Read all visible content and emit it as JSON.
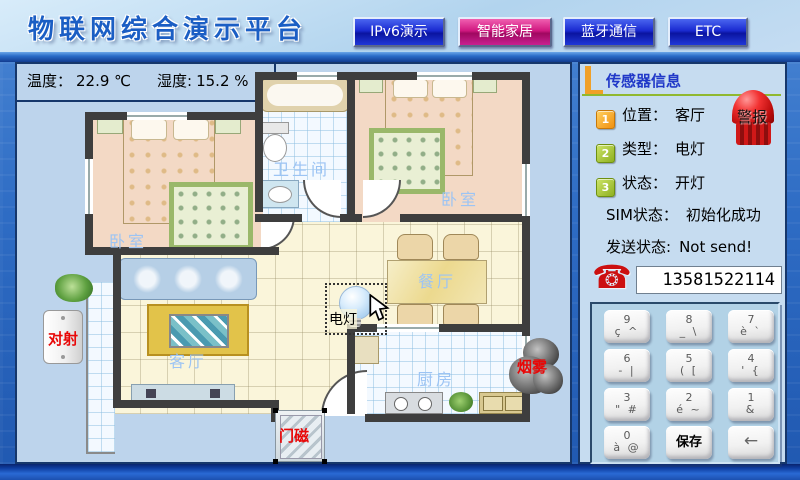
{
  "header": {
    "title": "物联网综合演示平台",
    "tabs": [
      {
        "label": "IPv6演示"
      },
      {
        "label": "智能家居"
      },
      {
        "label": "蓝牙通信"
      },
      {
        "label": "ETC"
      }
    ]
  },
  "env": {
    "temp_label": "温度：",
    "temp_value": "22.9 ℃",
    "hum_label": "湿度:",
    "hum_value": "15.2 %"
  },
  "floorplan": {
    "rooms": {
      "bedroom_left": "卧室",
      "bathroom": "卫生间",
      "bedroom_right": "卧室",
      "dining": "餐厅",
      "living": "客厅",
      "kitchen": "厨房"
    },
    "sensors": {
      "beam": "对射",
      "door_magnet": "门磁",
      "lamp": "电灯",
      "smoke": "烟雾"
    }
  },
  "sensor_panel": {
    "title": "传感器信息",
    "alarm_label": "警报",
    "items": [
      {
        "num": "1",
        "label": "位置：",
        "value": "客厅"
      },
      {
        "num": "2",
        "label": "类型：",
        "value": "电灯"
      },
      {
        "num": "3",
        "label": "状态：",
        "value": "开灯"
      }
    ],
    "sim_label": "SIM状态：",
    "sim_value": "初始化成功",
    "send_label": "发送状态:",
    "send_value": "Not send!",
    "phone": {
      "icon": "☎",
      "number": "13581522114"
    },
    "keypad": {
      "keys": [
        {
          "top": "9",
          "sub": "ç ^"
        },
        {
          "top": "8",
          "sub": "_ \\"
        },
        {
          "top": "7",
          "sub": "è `"
        },
        {
          "top": "6",
          "sub": "- |"
        },
        {
          "top": "5",
          "sub": "( ["
        },
        {
          "top": "4",
          "sub": "' {"
        },
        {
          "top": "3",
          "sub": "\" #"
        },
        {
          "top": "2",
          "sub": "é ~"
        },
        {
          "top": "1",
          "sub": "&"
        },
        {
          "top": "0",
          "sub": "à @"
        }
      ],
      "save_label": "保存",
      "backspace_label": "←"
    }
  }
}
